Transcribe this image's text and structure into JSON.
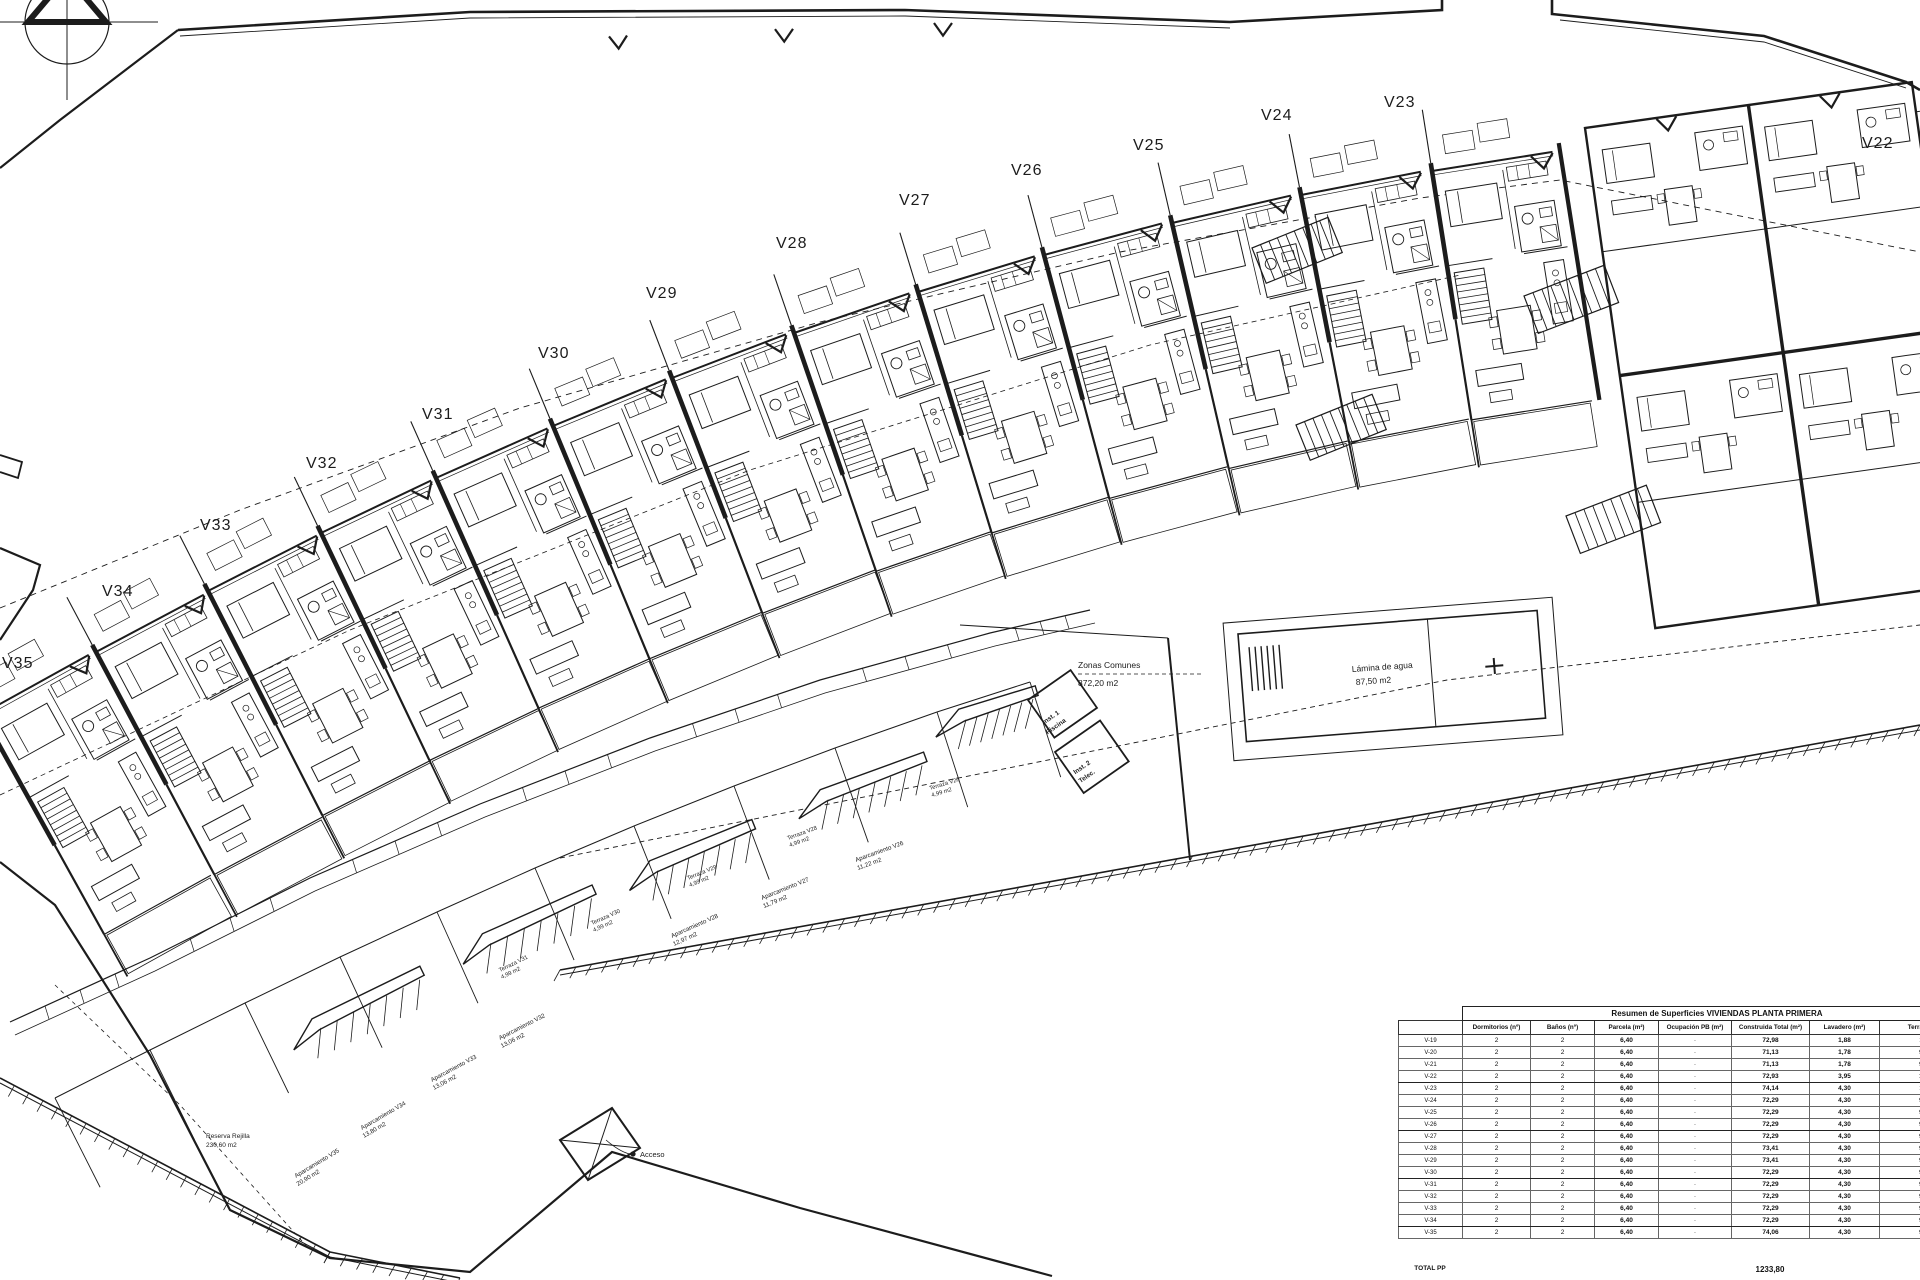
{
  "canvas": {
    "width": 1920,
    "height": 1280,
    "background": "#ffffff",
    "ink": "#1c1c1c"
  },
  "compass": {
    "name": "north-arrow"
  },
  "plan": {
    "unit_labels": [
      {
        "id": "V22",
        "x": 1862,
        "y": 148
      },
      {
        "id": "V23",
        "x": 1384,
        "y": 107
      },
      {
        "id": "V24",
        "x": 1261,
        "y": 120
      },
      {
        "id": "V25",
        "x": 1133,
        "y": 150
      },
      {
        "id": "V26",
        "x": 1011,
        "y": 175
      },
      {
        "id": "V27",
        "x": 899,
        "y": 205
      },
      {
        "id": "V28",
        "x": 776,
        "y": 248
      },
      {
        "id": "V29",
        "x": 646,
        "y": 298
      },
      {
        "id": "V30",
        "x": 538,
        "y": 358
      },
      {
        "id": "V31",
        "x": 422,
        "y": 419
      },
      {
        "id": "V32",
        "x": 306,
        "y": 468
      },
      {
        "id": "V33",
        "x": 200,
        "y": 530
      },
      {
        "id": "V34",
        "x": 102,
        "y": 596
      },
      {
        "id": "V35",
        "x": 2,
        "y": 668
      }
    ],
    "units": [
      {
        "label": "V35",
        "x": -18,
        "y": 714,
        "angle": -29
      },
      {
        "label": "V34",
        "x": 96,
        "y": 652,
        "angle": -28
      },
      {
        "label": "V33",
        "x": 208,
        "y": 591,
        "angle": -27
      },
      {
        "label": "V32",
        "x": 321,
        "y": 533,
        "angle": -25.5
      },
      {
        "label": "V31",
        "x": 436,
        "y": 478,
        "angle": -24
      },
      {
        "label": "V30",
        "x": 553,
        "y": 426,
        "angle": -22.5
      },
      {
        "label": "V29",
        "x": 672,
        "y": 378,
        "angle": -21
      },
      {
        "label": "V28",
        "x": 794,
        "y": 333,
        "angle": -19
      },
      {
        "label": "V27",
        "x": 918,
        "y": 292,
        "angle": -17
      },
      {
        "label": "V26",
        "x": 1044,
        "y": 255,
        "angle": -15
      },
      {
        "label": "V25",
        "x": 1172,
        "y": 223,
        "angle": -13
      },
      {
        "label": "V24",
        "x": 1301,
        "y": 195,
        "angle": -11
      },
      {
        "label": "V23",
        "x": 1432,
        "y": 171,
        "angle": -9
      }
    ],
    "annotations": {
      "zonas_comunes": {
        "line1": "Zonas Comunes",
        "line2": "872,20 m2",
        "x": 1078,
        "y": 668
      },
      "lamina": {
        "line1": "Lámina de agua",
        "line2": "87,50 m2",
        "x": 1352,
        "y": 672
      },
      "inst1": {
        "line1": "Inst. 1",
        "line2": "Piscina",
        "x": 1052,
        "y": 719
      },
      "inst2": {
        "line1": "Inst. 2",
        "line2": "Telec.",
        "x": 1083,
        "y": 769
      },
      "acceso": {
        "text": "Acceso",
        "x": 640,
        "y": 1156
      },
      "reserva": {
        "line1": "Reserva Rejilla",
        "line2": "230,60 m2",
        "x": 206,
        "y": 1138
      }
    },
    "parking_labels": [
      {
        "l1": "Aparcamiento V26",
        "l2": "11,22 m2",
        "x": 856,
        "y": 862,
        "angle": -20
      },
      {
        "l1": "Aparcamiento V27",
        "l2": "11,79 m2",
        "x": 762,
        "y": 900,
        "angle": -22
      },
      {
        "l1": "Aparcamiento V28",
        "l2": "12,97 m2",
        "x": 672,
        "y": 938,
        "angle": -24
      },
      {
        "l1": "Aparcamiento V32",
        "l2": "13,06 m2",
        "x": 500,
        "y": 1040,
        "angle": -27
      },
      {
        "l1": "Aparcamiento V33",
        "l2": "13,06 m2",
        "x": 432,
        "y": 1082,
        "angle": -28
      },
      {
        "l1": "Aparcamiento V34",
        "l2": "13,80 m2",
        "x": 362,
        "y": 1130,
        "angle": -30
      },
      {
        "l1": "Aparcamiento V35",
        "l2": "20,90 m2",
        "x": 296,
        "y": 1178,
        "angle": -31
      }
    ],
    "terrace_labels": [
      {
        "l1": "Terraza V31",
        "l2": "4,99 m2",
        "x": 500,
        "y": 972,
        "angle": -26
      },
      {
        "l1": "Terraza V30",
        "l2": "4,99 m2",
        "x": 592,
        "y": 925,
        "angle": -24
      },
      {
        "l1": "Terraza V29",
        "l2": "4,99 m2",
        "x": 688,
        "y": 880,
        "angle": -22
      },
      {
        "l1": "Terraza V28",
        "l2": "4,99 m2",
        "x": 788,
        "y": 840,
        "angle": -20
      },
      {
        "l1": "Terraza V26",
        "l2": "4,99 m2",
        "x": 930,
        "y": 790,
        "angle": -17
      }
    ]
  },
  "table": {
    "title": "Resumen de Superficies VIVIENDAS PLANTA PRIMERA",
    "columns": [
      "",
      "Dormitorios (nº)",
      "Baños (nº)",
      "Parcela (m²)",
      "Ocupación PB (m²)",
      "Construida Total (m²)",
      "Lavadero (m²)",
      "Terraza (m²)"
    ],
    "col_widths": [
      64,
      68,
      64,
      64,
      73,
      78,
      70,
      92
    ],
    "rows": [
      [
        "V-19",
        "2",
        "2",
        "6,40",
        "-",
        "72,98",
        "1,88",
        "11,5"
      ],
      [
        "V-20",
        "2",
        "2",
        "6,40",
        "-",
        "71,13",
        "1,78",
        "9,15"
      ],
      [
        "V-21",
        "2",
        "2",
        "6,40",
        "-",
        "71,13",
        "1,78",
        "9,15"
      ],
      [
        "V-22",
        "2",
        "2",
        "6,40",
        "-",
        "72,93",
        "3,95",
        "10,2"
      ],
      [
        "V-23",
        "2",
        "2",
        "6,40",
        "-",
        "74,14",
        "4,30",
        "11,2"
      ],
      [
        "V-24",
        "2",
        "2",
        "6,40",
        "-",
        "72,29",
        "4,30",
        "9,15"
      ],
      [
        "V-25",
        "2",
        "2",
        "6,40",
        "-",
        "72,29",
        "4,30",
        "9,15"
      ],
      [
        "V-26",
        "2",
        "2",
        "6,40",
        "-",
        "72,29",
        "4,30",
        "9,15"
      ],
      [
        "V-27",
        "2",
        "2",
        "6,40",
        "-",
        "72,29",
        "4,30",
        "9,15"
      ],
      [
        "V-28",
        "2",
        "2",
        "6,40",
        "-",
        "73,41",
        "4,30",
        "9,15"
      ],
      [
        "V-29",
        "2",
        "2",
        "6,40",
        "-",
        "73,41",
        "4,30",
        "9,15"
      ],
      [
        "V-30",
        "2",
        "2",
        "6,40",
        "-",
        "72,29",
        "4,30",
        "9,15"
      ],
      [
        "V-31",
        "2",
        "2",
        "6,40",
        "-",
        "72,29",
        "4,30",
        "9,15"
      ],
      [
        "V-32",
        "2",
        "2",
        "6,40",
        "-",
        "72,29",
        "4,30",
        "9,15"
      ],
      [
        "V-33",
        "2",
        "2",
        "6,40",
        "-",
        "72,29",
        "4,30",
        "9,15"
      ],
      [
        "V-34",
        "2",
        "2",
        "6,40",
        "-",
        "72,29",
        "4,30",
        "9,15"
      ],
      [
        "V-35",
        "2",
        "2",
        "6,40",
        "-",
        "74,06",
        "4,30",
        "9,65"
      ]
    ],
    "total_label": "TOTAL PP",
    "total_value": "1233,80"
  }
}
